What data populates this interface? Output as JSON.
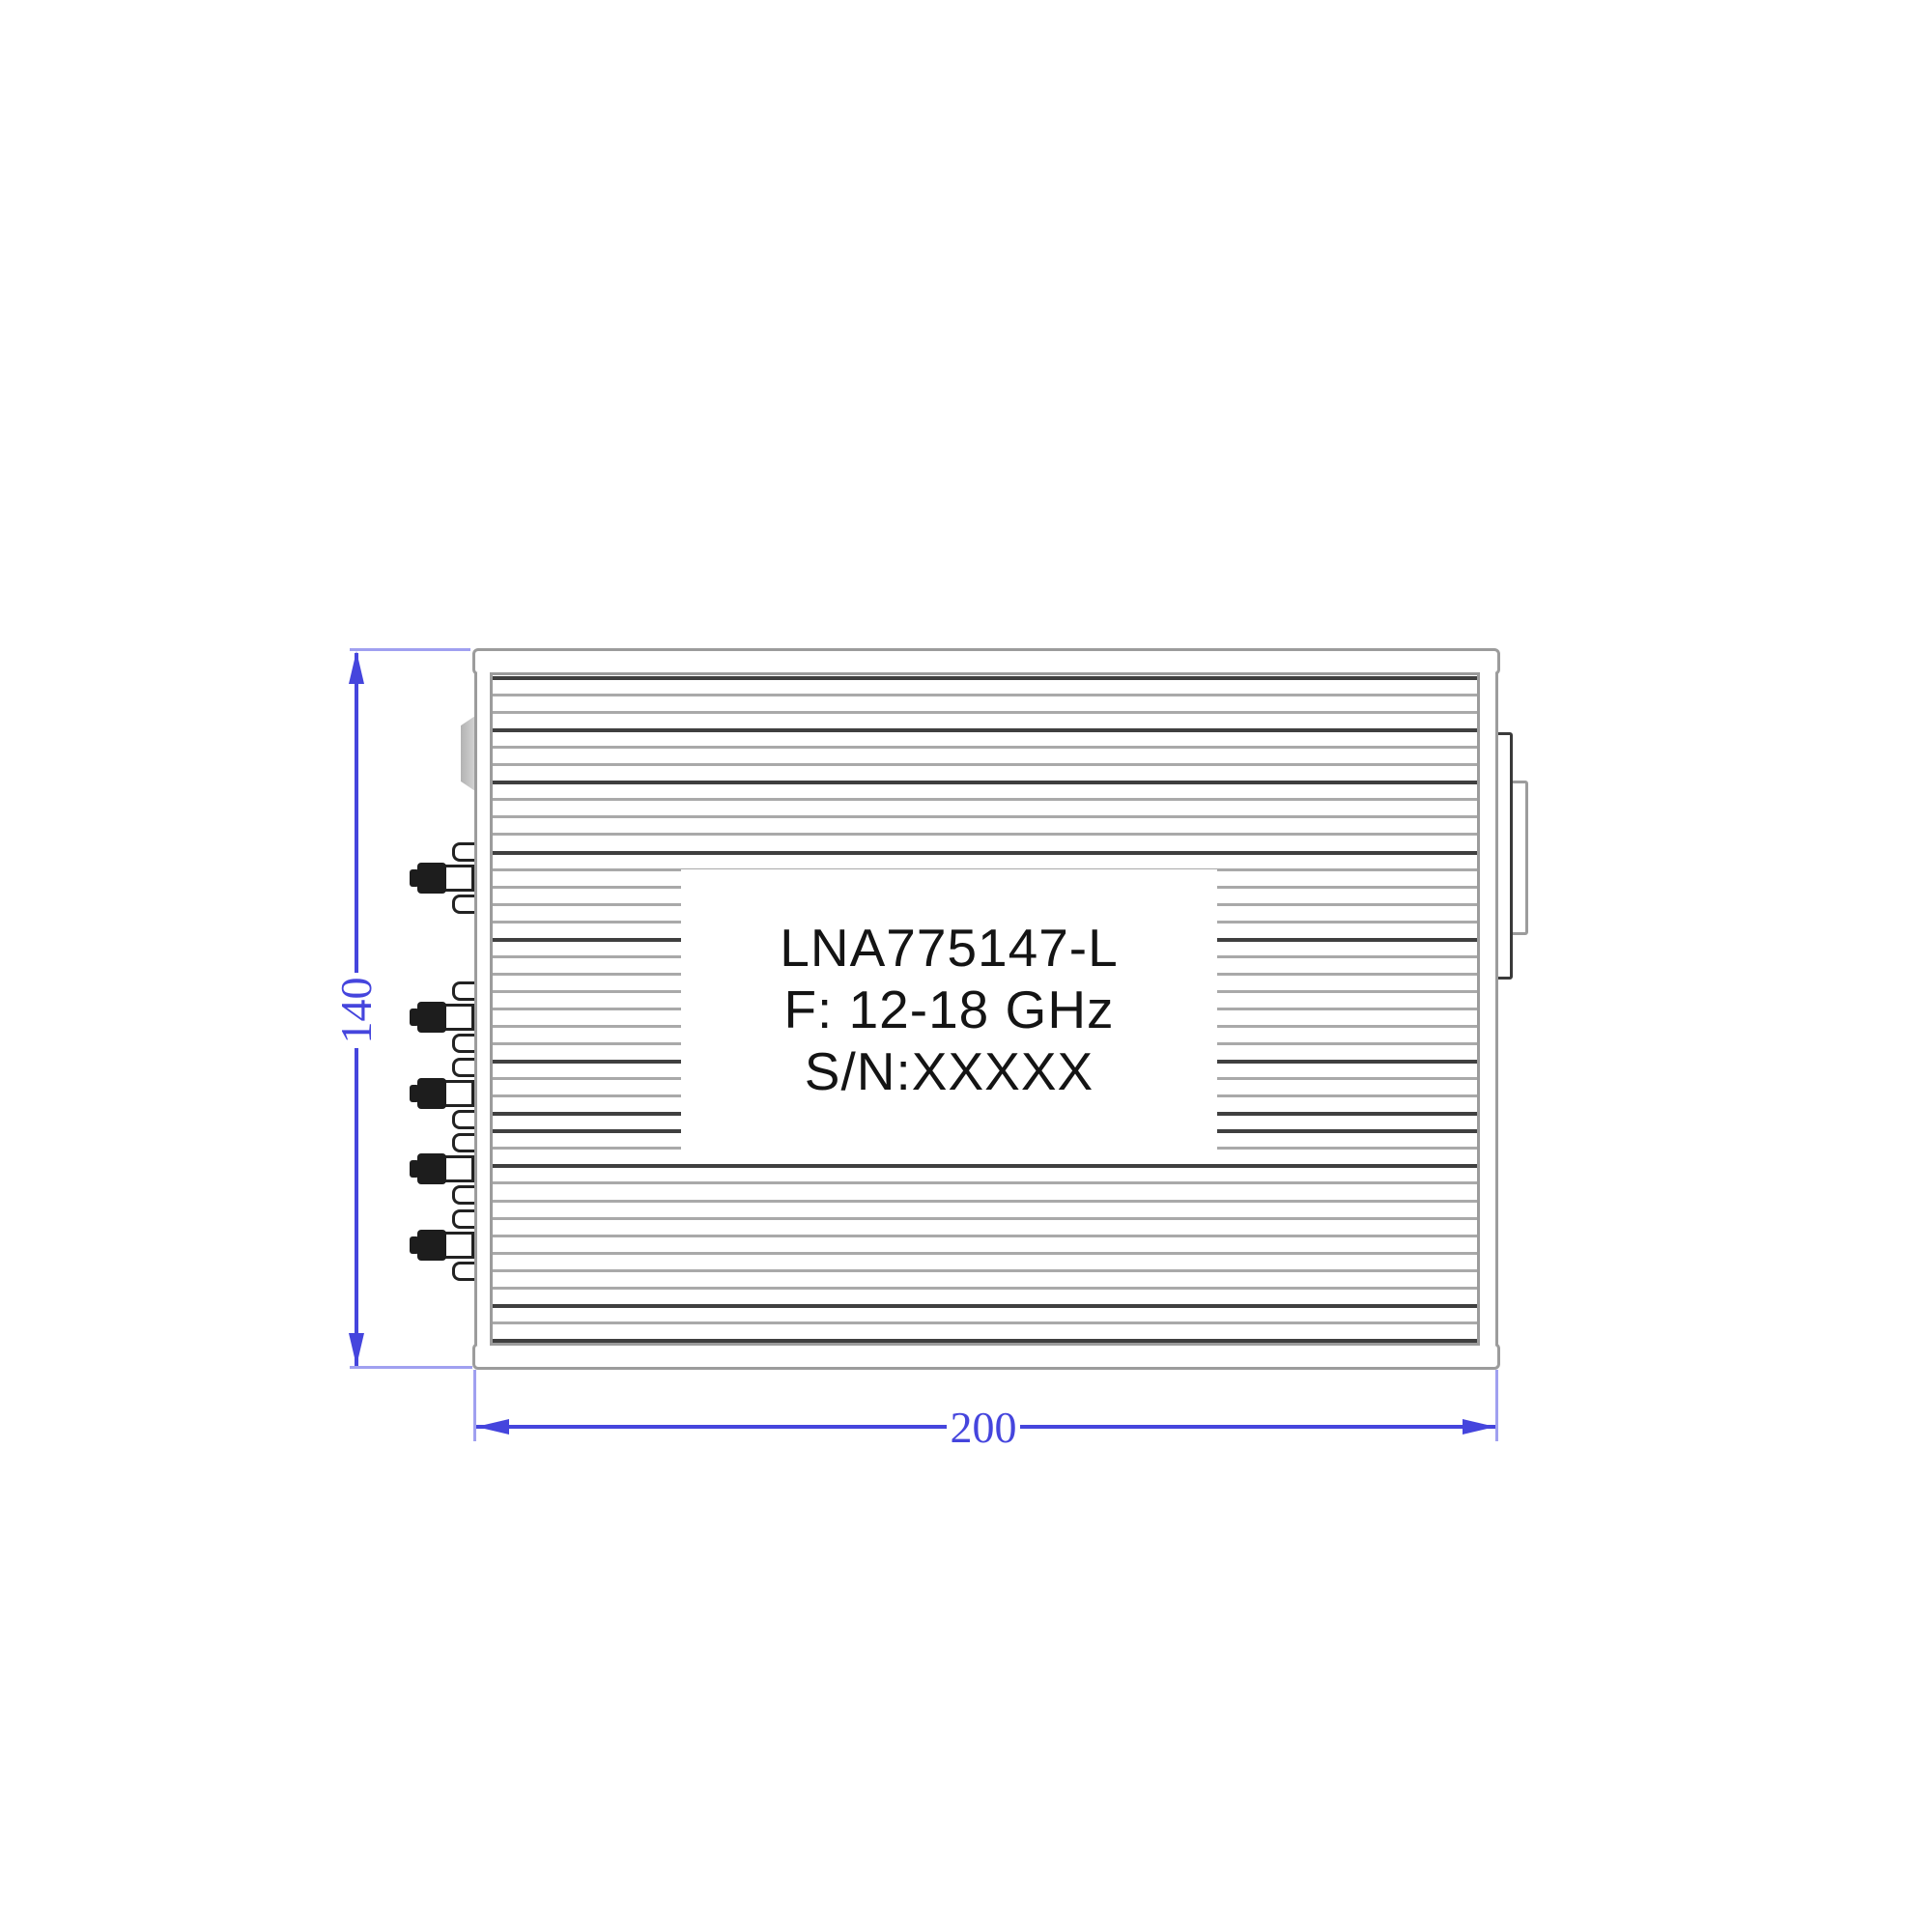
{
  "drawing": {
    "type": "mechanical-drawing-side-view",
    "device_label": {
      "model": "LNA775147-L",
      "frequency": "F: 12-18 GHz",
      "serial": "S/N:XXXXX"
    },
    "dimensions": {
      "height": {
        "value": "140"
      },
      "width": {
        "value": "200"
      }
    },
    "colors": {
      "dimension_blue": "#4545dd",
      "extension_blue": "#a0a0f0",
      "outline_gray": "#9c9c9c",
      "fin_gray": "#a9a9a9",
      "fin_dark": "#3f3f3f",
      "connector_black": "#1d1d1d",
      "label_text": "#141414"
    }
  }
}
